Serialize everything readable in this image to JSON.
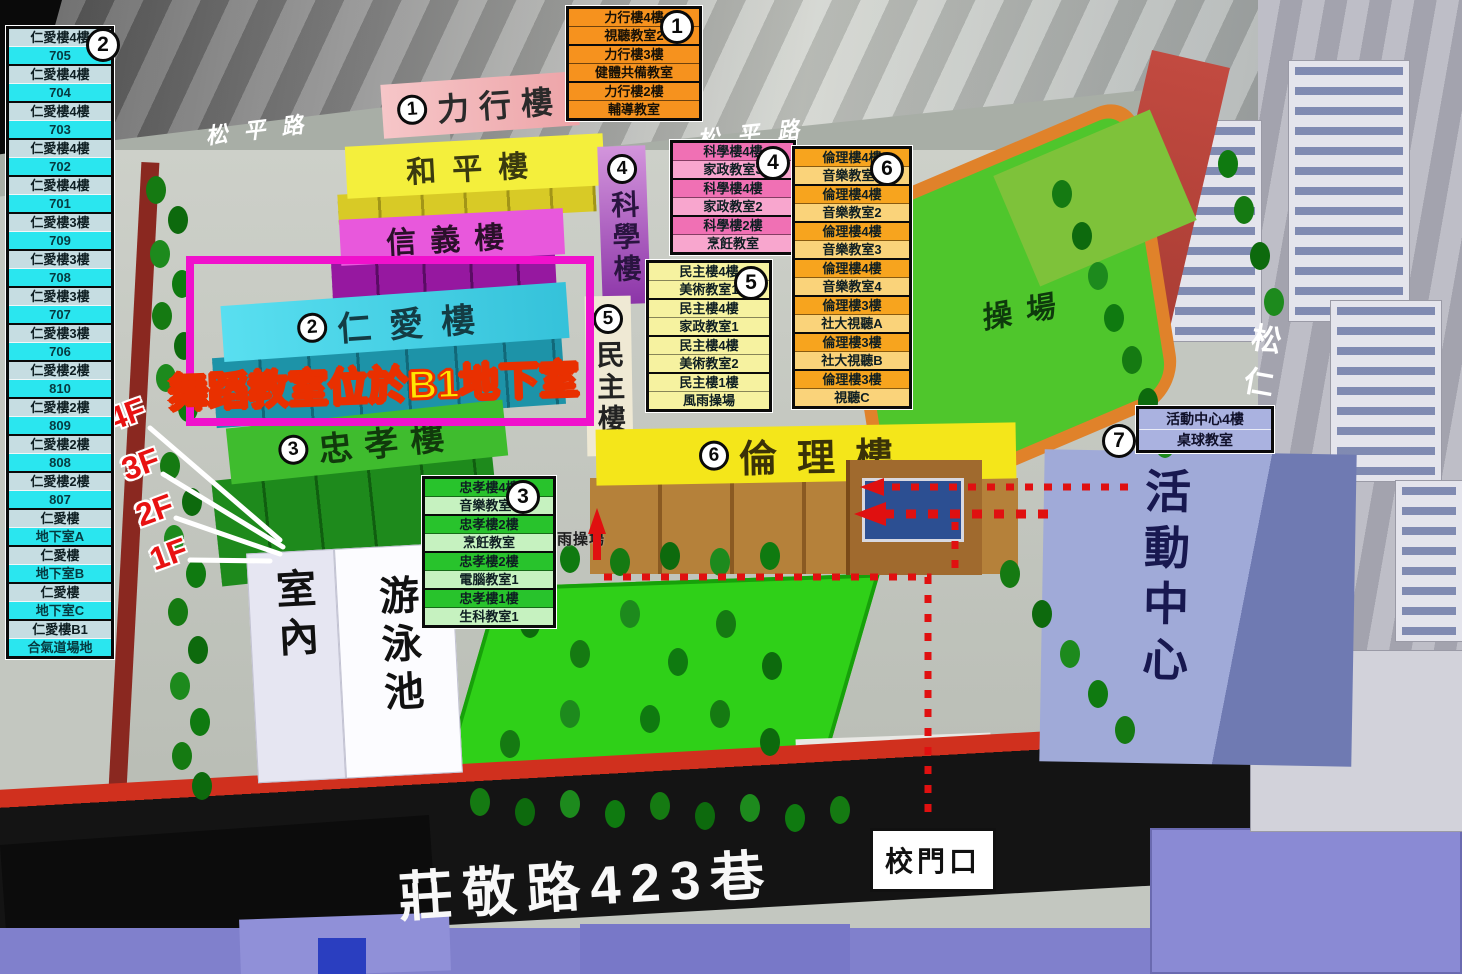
{
  "jen_ai_list": {
    "badge": "2",
    "entries": [
      {
        "floor": "仁愛樓4樓",
        "room": "705"
      },
      {
        "floor": "仁愛樓4樓",
        "room": "704"
      },
      {
        "floor": "仁愛樓4樓",
        "room": "703"
      },
      {
        "floor": "仁愛樓4樓",
        "room": "702"
      },
      {
        "floor": "仁愛樓4樓",
        "room": "701"
      },
      {
        "floor": "仁愛樓3樓",
        "room": "709"
      },
      {
        "floor": "仁愛樓3樓",
        "room": "708"
      },
      {
        "floor": "仁愛樓3樓",
        "room": "707"
      },
      {
        "floor": "仁愛樓3樓",
        "room": "706"
      },
      {
        "floor": "仁愛樓2樓",
        "room": "810"
      },
      {
        "floor": "仁愛樓2樓",
        "room": "809"
      },
      {
        "floor": "仁愛樓2樓",
        "room": "808"
      },
      {
        "floor": "仁愛樓2樓",
        "room": "807"
      },
      {
        "floor": "仁愛樓",
        "room": "地下室A"
      },
      {
        "floor": "仁愛樓",
        "room": "地下室B"
      },
      {
        "floor": "仁愛樓",
        "room": "地下室C"
      },
      {
        "floor": "仁愛樓B1",
        "room": "合氣道場地"
      }
    ]
  },
  "box_lixing": {
    "badge": "1",
    "entries": [
      {
        "floor": "力行樓4樓",
        "room": "視聽教室2"
      },
      {
        "floor": "力行樓3樓",
        "room": "健體共備教室"
      },
      {
        "floor": "力行樓2樓",
        "room": "輔導教室"
      }
    ]
  },
  "box_science": {
    "badge": "4",
    "entries": [
      {
        "floor": "科學樓4樓",
        "room": "家政教室3"
      },
      {
        "floor": "科學樓4樓",
        "room": "家政教室2"
      },
      {
        "floor": "科學樓2樓",
        "room": "烹飪教室"
      }
    ]
  },
  "box_minzhu": {
    "badge": "5",
    "entries": [
      {
        "floor": "民主樓4樓",
        "room": "美術教室1"
      },
      {
        "floor": "民主樓4樓",
        "room": "家政教室1"
      },
      {
        "floor": "民主樓4樓",
        "room": "美術教室2"
      },
      {
        "floor": "民主樓1樓",
        "room": "風雨操場"
      }
    ]
  },
  "box_lunli": {
    "badge": "6",
    "entries": [
      {
        "floor": "倫理樓4樓",
        "room": "音樂教室1"
      },
      {
        "floor": "倫理樓4樓",
        "room": "音樂教室2"
      },
      {
        "floor": "倫理樓4樓",
        "room": "音樂教室3"
      },
      {
        "floor": "倫理樓4樓",
        "room": "音樂教室4"
      },
      {
        "floor": "倫理樓3樓",
        "room": "社大視聽A"
      },
      {
        "floor": "倫理樓3樓",
        "room": "社大視聽B"
      },
      {
        "floor": "倫理樓3樓",
        "room": "視聽C"
      }
    ]
  },
  "box_zhongxiao": {
    "badge": "3",
    "entries": [
      {
        "floor": "忠孝樓4樓",
        "room": "音樂教室5"
      },
      {
        "floor": "忠孝樓2樓",
        "room": "烹飪教室"
      },
      {
        "floor": "忠孝樓2樓",
        "room": "電腦教室1"
      },
      {
        "floor": "忠孝樓1樓",
        "room": "生科教室1"
      }
    ]
  },
  "box_activity": {
    "badge": "7",
    "entries": [
      {
        "floor": "活動中心4樓",
        "room": "桌球教室"
      }
    ]
  },
  "buildings": {
    "lixing": {
      "badge": "1",
      "name": "力行樓"
    },
    "heping": {
      "name": "和平樓"
    },
    "xinyi": {
      "name": "信義樓"
    },
    "renai": {
      "badge": "2",
      "name": "仁愛樓"
    },
    "zhongxiao": {
      "badge": "3",
      "name": "忠孝樓"
    },
    "kexue": {
      "badge": "4",
      "name": "科學樓"
    },
    "minzhu": {
      "badge": "5",
      "name": "民主樓"
    },
    "lunli": {
      "badge": "6",
      "name": "倫理樓"
    },
    "activity_center": {
      "name": "活動中心"
    },
    "pool_left_face": "室內",
    "pool_right_face": "游泳池",
    "playground": "操場",
    "rain_playground": "風雨操場"
  },
  "roads": {
    "songping_left": "松平路",
    "songping_right": "松平路",
    "songren": "松仁路",
    "zhuangjing": "莊敬路423巷"
  },
  "labels": {
    "gate": "校門口",
    "announcement": "舞蹈教室位於B1地下室",
    "floors": [
      "4F",
      "3F",
      "2F",
      "1F"
    ]
  },
  "colors": {
    "highlight_magenta": "#F011CC",
    "announcement_yellow": "#FFE603",
    "announcement_outline": "#E93000",
    "route_red": "#E01010",
    "floor_label_red": "#E81212",
    "renai_cyan": "#35C2DA",
    "zhongxiao_green": "#3FBC2E",
    "lunli_yellow": "#F4E61A",
    "activity_lavender": "#9AA4D4"
  }
}
